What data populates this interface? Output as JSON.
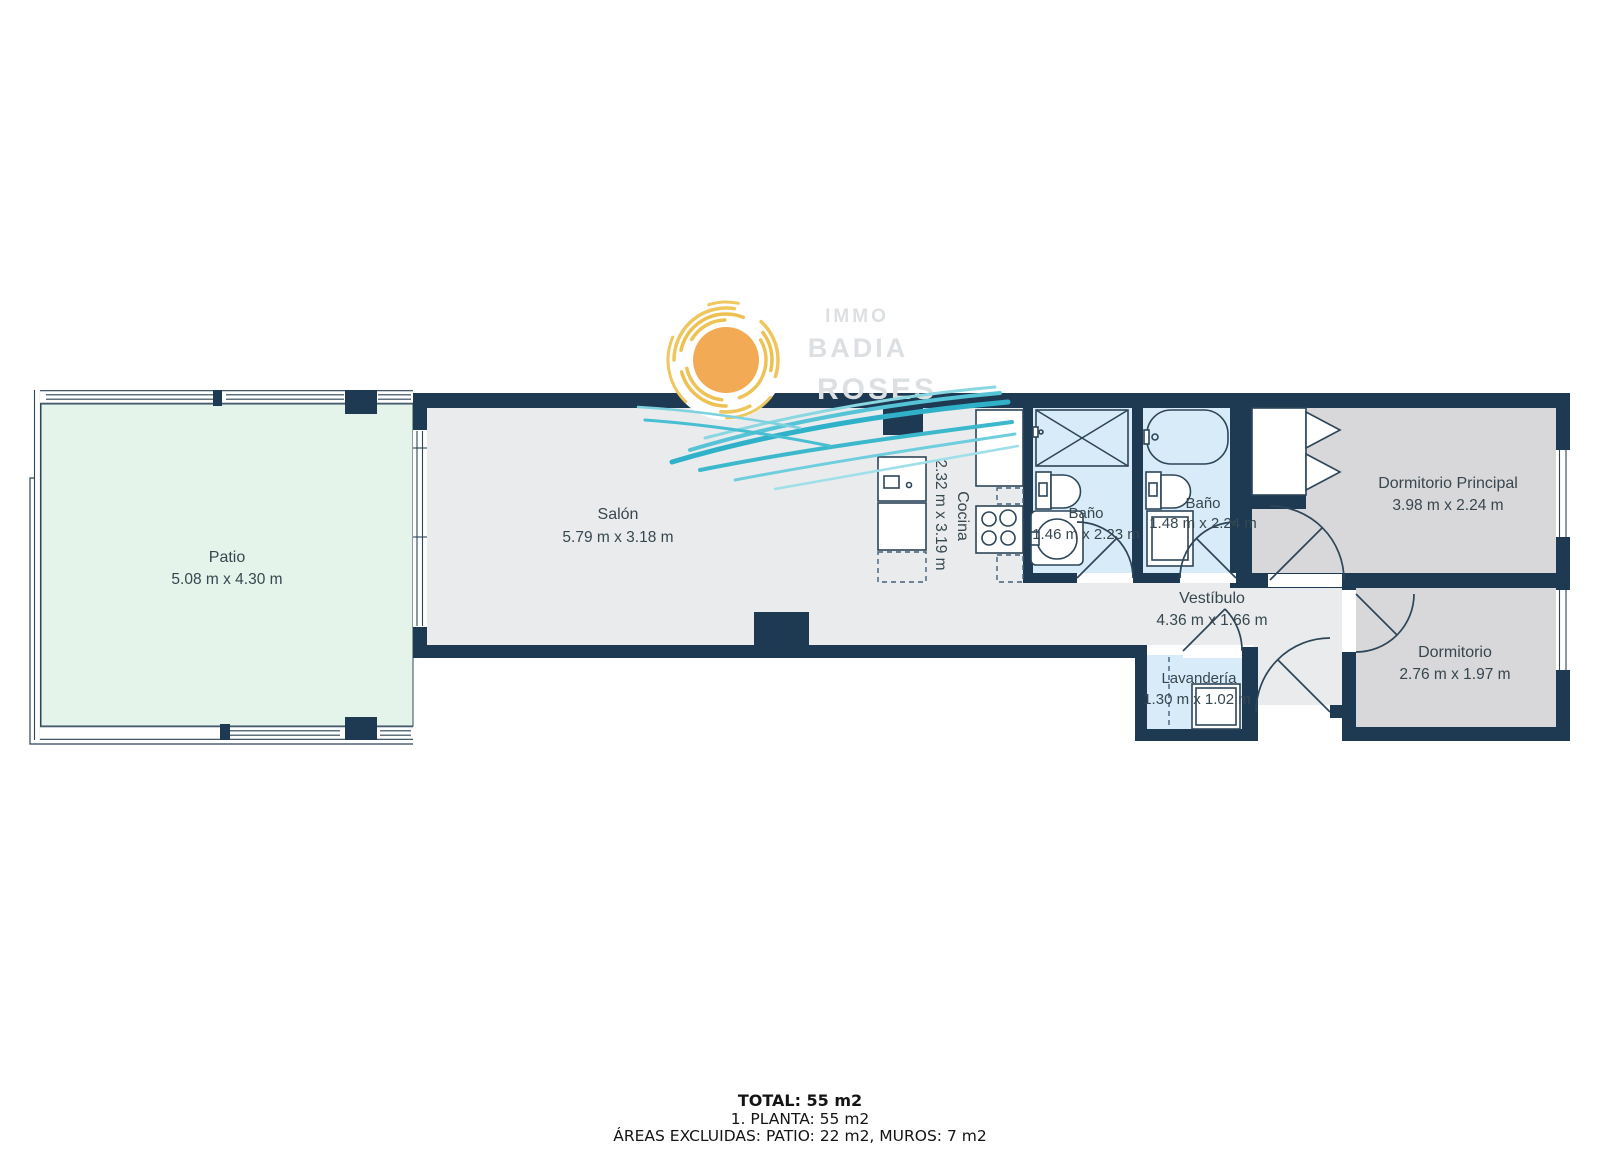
{
  "watermark": {
    "line1": "IMMO",
    "line2": "BADIA",
    "line3": "ROSES"
  },
  "rooms": {
    "patio": {
      "name": "Patio",
      "dims": "5.08 m x 4.30 m"
    },
    "salon": {
      "name": "Salón",
      "dims": "5.79 m x 3.18 m"
    },
    "cocina": {
      "name": "Cocina",
      "dims": "2.32 m x 3.19 m"
    },
    "bano1": {
      "name": "Baño",
      "dims": "1.46 m x 2.23 m"
    },
    "bano2": {
      "name": "Baño",
      "dims": "1.48 m x 2.24 m"
    },
    "dormitorio_principal": {
      "name": "Dormitorio Principal",
      "dims": "3.98 m x 2.24 m"
    },
    "vestibulo": {
      "name": "Vestíbulo",
      "dims": "4.36 m x 1.66 m"
    },
    "lavanderia": {
      "name": "Lavandería",
      "dims": "1.30 m x 1.02 m"
    },
    "dormitorio": {
      "name": "Dormitorio",
      "dims": "2.76 m x 1.97 m"
    }
  },
  "summary": {
    "total": "TOTAL: 55 m2",
    "floor": "1. PLANTA: 55 m2",
    "excluded": "ÁREAS EXCLUIDAS: PATIO: 22 m2, MUROS: 7 m2"
  },
  "colors": {
    "wall": "#1e3a52",
    "floor": "#e9ebec",
    "bedroom_floor": "#d8d7d9",
    "bath_floor": "#d7ecf8",
    "patio_floor": "#e4f4ea",
    "sun": "#f2aa55",
    "sun_rays": "#eec254",
    "wave_dark": "#35b3c9",
    "wave_light": "#7fd3e0",
    "watermark": "#dde0e2",
    "label_text": "#37474f"
  }
}
